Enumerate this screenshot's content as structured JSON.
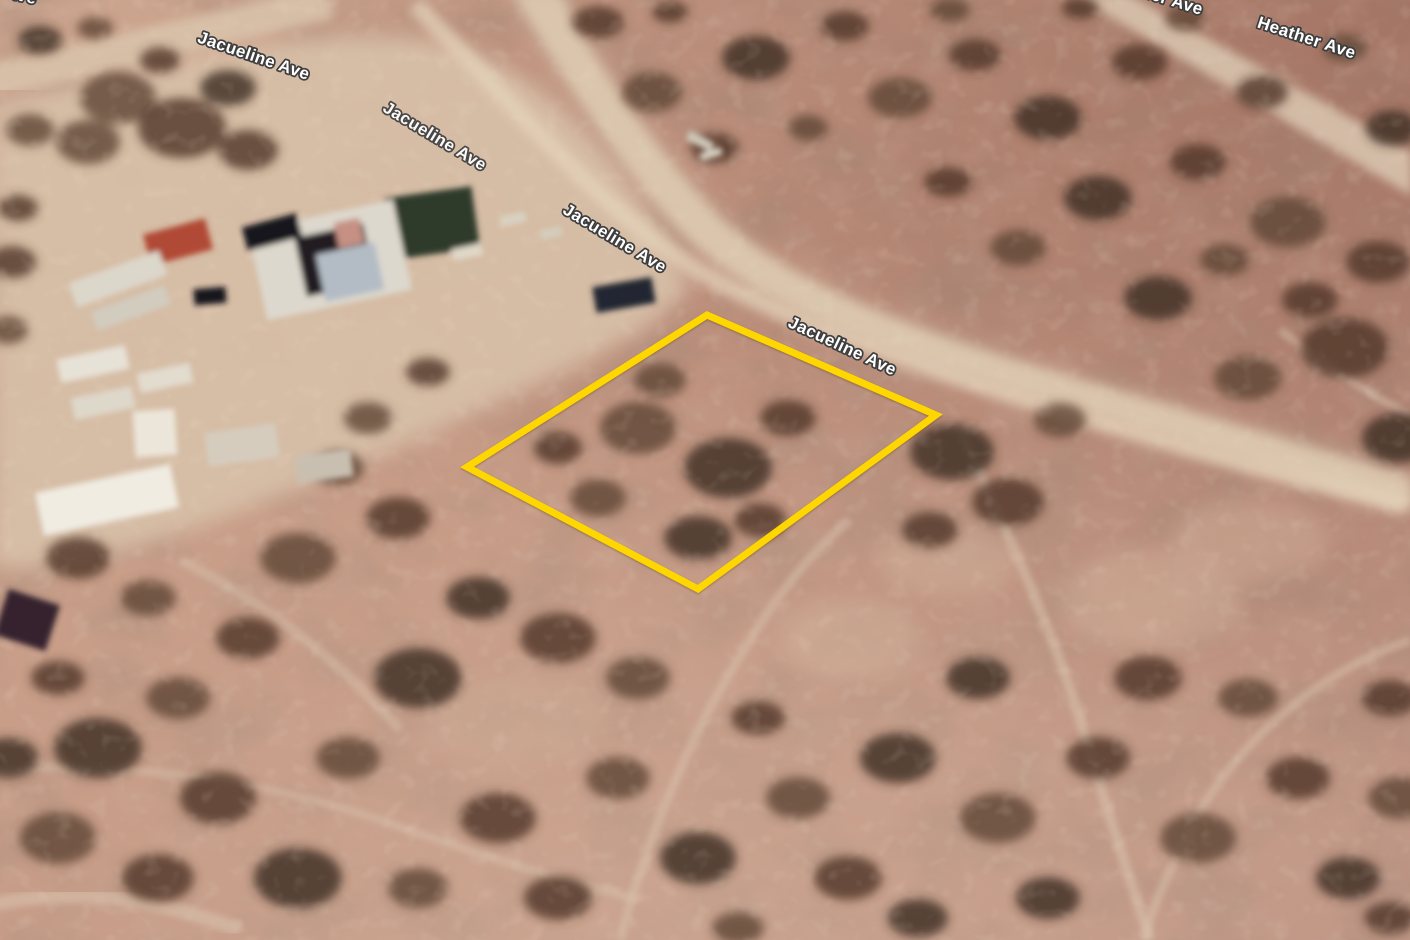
{
  "road_labels": [
    {
      "id": "jacueline-1",
      "text": "Jacueline Ave"
    },
    {
      "id": "jacueline-2",
      "text": "Jacueline Ave"
    },
    {
      "id": "jacueline-3",
      "text": "Jacueline Ave"
    },
    {
      "id": "jacueline-4",
      "text": "Jacueline Ave"
    },
    {
      "id": "heather-partial",
      "text": "Heather Ave"
    },
    {
      "id": "heather-1",
      "text": "Heather Ave"
    },
    {
      "id": "jacueline-fragment",
      "text": "Jacueline Ave"
    }
  ],
  "parcel_overlay": {
    "points": "707,315 936,415 698,589 467,467",
    "stroke_color": "#FFD700",
    "stroke_width": 7
  },
  "palette": {
    "label_fill": "#FFFFFF",
    "label_outline": "#3E3E3E",
    "road_sand": "#DCC6AE",
    "terrain_base": "#C49B88",
    "terrain_mauve": "#A87C6D",
    "bush_dark": "#4F352A",
    "parcel_yellow": "#FFD700"
  }
}
